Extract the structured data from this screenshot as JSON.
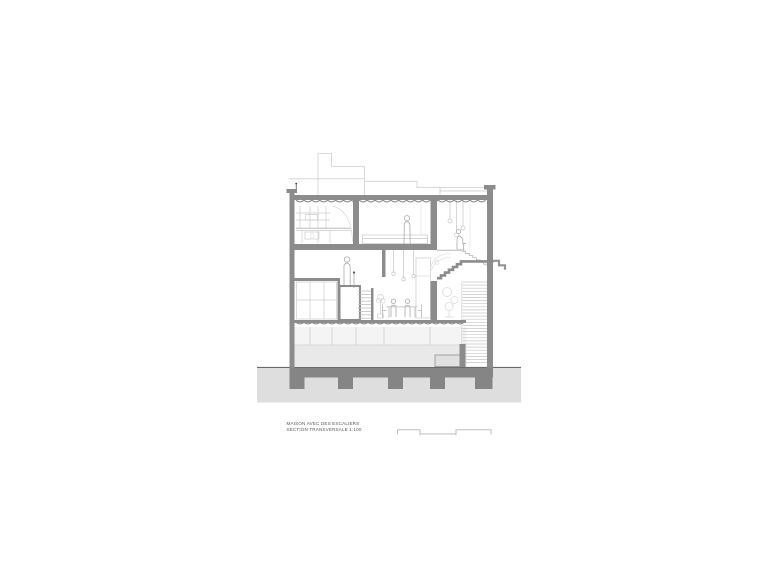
{
  "page": {
    "background_color": "#ffffff"
  },
  "caption": {
    "line1": "MAISON AVEC DES ESCALIERS",
    "line2": "SECTION TRANSVERSALE 1:100"
  },
  "scale_bar": {
    "style": "segmented graphic scale",
    "segments": 3
  },
  "colors": {
    "wall_gray": "#8c8c8c",
    "foundation_gray": "#858585",
    "ground_gray": "#dedede",
    "floor_tint": "#e9e9e9",
    "light_line": "#c9c9c9",
    "figure_line": "#b4b4b4",
    "caption_text": "#5a5a5a"
  },
  "drawing": {
    "type": "architectural cross-section",
    "levels": [
      "ground floor",
      "middle floor",
      "top floor",
      "roof"
    ],
    "depicted_elements": [
      "left parapet with small antenna",
      "kitchen shelving and counter",
      "bedroom with bed and standing figure",
      "stairwell with pendant lights",
      "split-level platform with stair",
      "dining table with seated figures and pendant lamps",
      "plants",
      "corrugated slab soffits",
      "roof terrace railing",
      "neighbour roofline / chimney outline",
      "foundation slab with five piers",
      "ground line"
    ],
    "figure_count": 5
  }
}
